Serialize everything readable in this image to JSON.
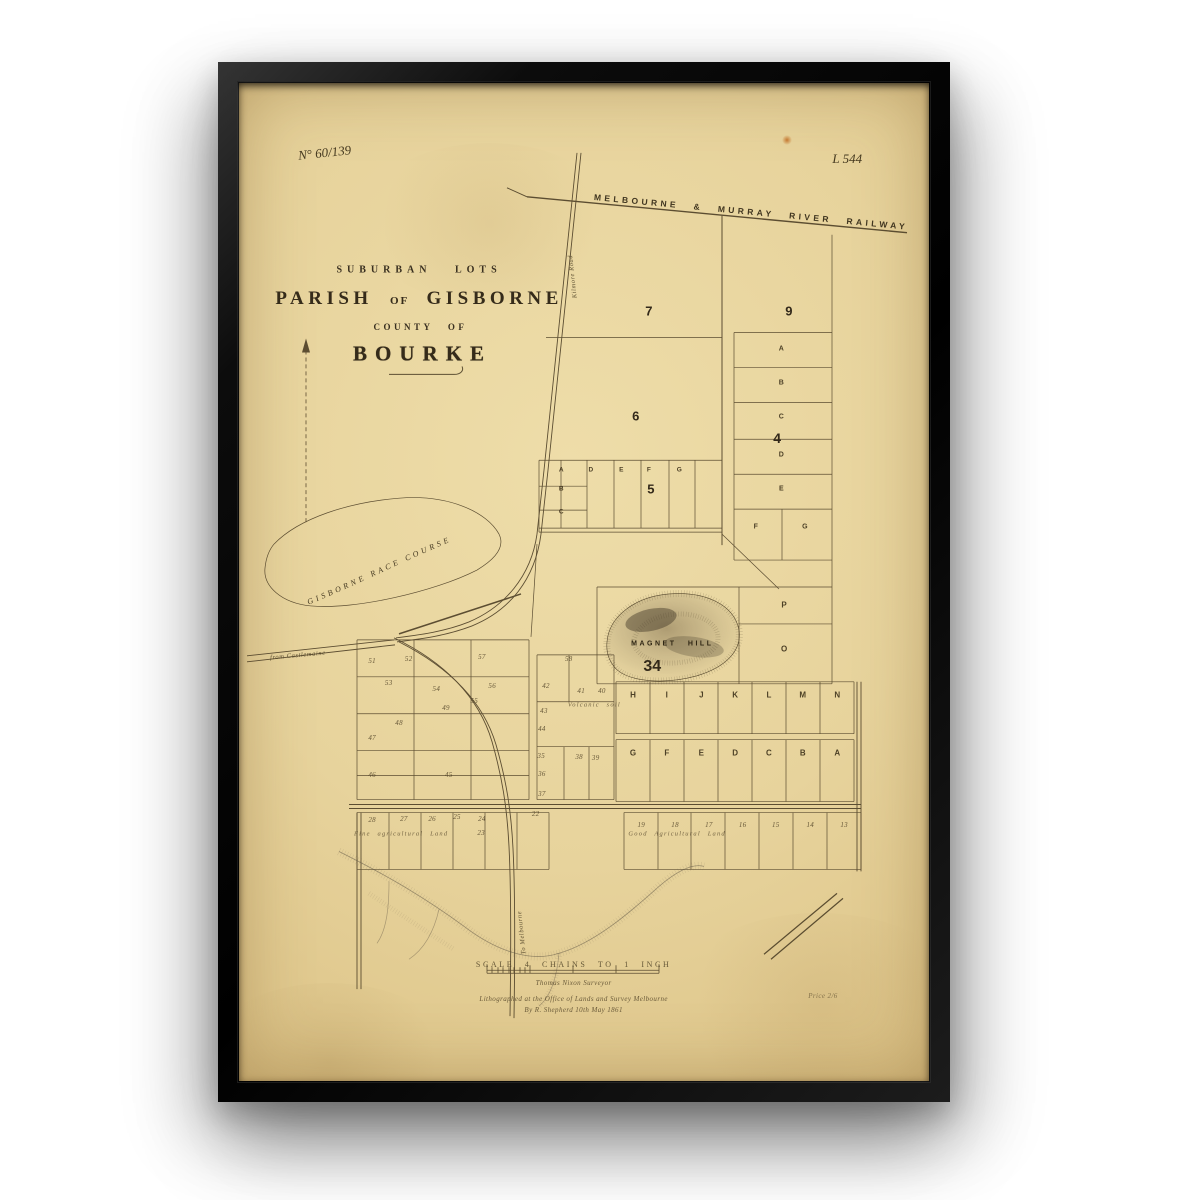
{
  "map": {
    "plate_no": "N° 60/139",
    "plate_ref": "L 544",
    "railway_label": "MELBOURNE & MURRAY RIVER RAILWAY",
    "title_line1": "SUBURBAN LOTS",
    "title_parish": "PARISH",
    "title_of": "OF",
    "title_gisborne": "GISBORNE",
    "title_line3": "COUNTY OF",
    "title_line4": "BOURKE",
    "race_course_label": "GISBORNE RACE COURSE",
    "magnet_hill_label": "MAGNET HILL",
    "magnet_hill_number": "34",
    "road_from_castlemaine": "from Castlemaine",
    "road_kilmore": "Kilmore Road",
    "road_to_melbourne": "To Melbourne",
    "sections": [
      {
        "label": "7",
        "x": 59.4,
        "y": 22.8,
        "size": 13
      },
      {
        "label": "9",
        "x": 79.7,
        "y": 22.8,
        "size": 13
      },
      {
        "label": "6",
        "x": 57.5,
        "y": 33.4,
        "size": 13
      },
      {
        "label": "5",
        "x": 59.7,
        "y": 40.7,
        "size": 13
      },
      {
        "label": "4",
        "x": 78.0,
        "y": 35.6,
        "size": 14
      }
    ],
    "letters": [
      {
        "ch": "A",
        "x": 78.6,
        "y": 26.7,
        "size": 7
      },
      {
        "ch": "B",
        "x": 78.6,
        "y": 30.1,
        "size": 7
      },
      {
        "ch": "C",
        "x": 78.6,
        "y": 33.5,
        "size": 7
      },
      {
        "ch": "D",
        "x": 78.6,
        "y": 37.3,
        "size": 7
      },
      {
        "ch": "E",
        "x": 78.6,
        "y": 40.7,
        "size": 7
      },
      {
        "ch": "F",
        "x": 74.9,
        "y": 44.5,
        "size": 7
      },
      {
        "ch": "G",
        "x": 82.0,
        "y": 44.5,
        "size": 7
      },
      {
        "ch": "A",
        "x": 46.7,
        "y": 38.8,
        "size": 6.5
      },
      {
        "ch": "D",
        "x": 51.0,
        "y": 38.8,
        "size": 6.5
      },
      {
        "ch": "E",
        "x": 55.4,
        "y": 38.8,
        "size": 6.5
      },
      {
        "ch": "F",
        "x": 59.4,
        "y": 38.8,
        "size": 6.5
      },
      {
        "ch": "G",
        "x": 63.8,
        "y": 38.8,
        "size": 6.5
      },
      {
        "ch": "B",
        "x": 46.7,
        "y": 40.7,
        "size": 6.5
      },
      {
        "ch": "C",
        "x": 46.7,
        "y": 43.0,
        "size": 6.5
      },
      {
        "ch": "P",
        "x": 79.0,
        "y": 52.3,
        "size": 8
      },
      {
        "ch": "O",
        "x": 79.0,
        "y": 56.7,
        "size": 8
      },
      {
        "ch": "H",
        "x": 57.1,
        "y": 61.3,
        "size": 8
      },
      {
        "ch": "I",
        "x": 62.0,
        "y": 61.3,
        "size": 8
      },
      {
        "ch": "J",
        "x": 67.0,
        "y": 61.3,
        "size": 8
      },
      {
        "ch": "K",
        "x": 71.9,
        "y": 61.3,
        "size": 8
      },
      {
        "ch": "L",
        "x": 76.8,
        "y": 61.3,
        "size": 8
      },
      {
        "ch": "M",
        "x": 81.7,
        "y": 61.3,
        "size": 8
      },
      {
        "ch": "N",
        "x": 86.7,
        "y": 61.3,
        "size": 8
      },
      {
        "ch": "G",
        "x": 57.1,
        "y": 67.1,
        "size": 8
      },
      {
        "ch": "F",
        "x": 62.0,
        "y": 67.1,
        "size": 8
      },
      {
        "ch": "E",
        "x": 67.0,
        "y": 67.1,
        "size": 8
      },
      {
        "ch": "D",
        "x": 71.9,
        "y": 67.1,
        "size": 8
      },
      {
        "ch": "C",
        "x": 76.8,
        "y": 67.1,
        "size": 8
      },
      {
        "ch": "B",
        "x": 81.7,
        "y": 67.1,
        "size": 8
      },
      {
        "ch": "A",
        "x": 86.7,
        "y": 67.1,
        "size": 8
      }
    ],
    "lots": [
      {
        "n": "51",
        "x": 19.3,
        "y": 57.9
      },
      {
        "n": "52",
        "x": 24.6,
        "y": 57.7
      },
      {
        "n": "57",
        "x": 35.2,
        "y": 57.5
      },
      {
        "n": "58",
        "x": 47.8,
        "y": 57.7
      },
      {
        "n": "53",
        "x": 21.7,
        "y": 60.1
      },
      {
        "n": "54",
        "x": 28.6,
        "y": 60.7
      },
      {
        "n": "56",
        "x": 36.7,
        "y": 60.4
      },
      {
        "n": "55",
        "x": 34.1,
        "y": 61.9
      },
      {
        "n": "49",
        "x": 30.0,
        "y": 62.6
      },
      {
        "n": "48",
        "x": 23.2,
        "y": 64.1
      },
      {
        "n": "47",
        "x": 19.3,
        "y": 65.6
      },
      {
        "n": "46",
        "x": 19.3,
        "y": 69.3
      },
      {
        "n": "45",
        "x": 30.4,
        "y": 69.3
      },
      {
        "n": "42",
        "x": 44.5,
        "y": 60.4
      },
      {
        "n": "41",
        "x": 49.6,
        "y": 60.9
      },
      {
        "n": "40",
        "x": 52.6,
        "y": 60.9
      },
      {
        "n": "43",
        "x": 44.2,
        "y": 62.9
      },
      {
        "n": "44",
        "x": 43.9,
        "y": 64.7
      },
      {
        "n": "35",
        "x": 43.8,
        "y": 67.4
      },
      {
        "n": "38",
        "x": 49.3,
        "y": 67.5
      },
      {
        "n": "39",
        "x": 51.7,
        "y": 67.6
      },
      {
        "n": "36",
        "x": 43.9,
        "y": 69.2
      },
      {
        "n": "37",
        "x": 43.9,
        "y": 71.2
      },
      {
        "n": "28",
        "x": 19.3,
        "y": 73.8
      },
      {
        "n": "27",
        "x": 23.9,
        "y": 73.7
      },
      {
        "n": "26",
        "x": 28.0,
        "y": 73.7
      },
      {
        "n": "25",
        "x": 31.6,
        "y": 73.5
      },
      {
        "n": "24",
        "x": 35.2,
        "y": 73.7
      },
      {
        "n": "23",
        "x": 35.1,
        "y": 75.2
      },
      {
        "n": "22",
        "x": 43.0,
        "y": 73.2
      },
      {
        "n": "19",
        "x": 58.3,
        "y": 74.3
      },
      {
        "n": "18",
        "x": 63.2,
        "y": 74.3
      },
      {
        "n": "17",
        "x": 68.1,
        "y": 74.3
      },
      {
        "n": "16",
        "x": 73.0,
        "y": 74.3
      },
      {
        "n": "15",
        "x": 77.8,
        "y": 74.3
      },
      {
        "n": "14",
        "x": 82.8,
        "y": 74.3
      },
      {
        "n": "13",
        "x": 87.7,
        "y": 74.3
      }
    ],
    "notes": [
      {
        "text": "Volcanic soil",
        "x": 51.5,
        "y": 62.3
      },
      {
        "text": "Fine agricultural Land",
        "x": 23.5,
        "y": 75.3
      },
      {
        "text": "Good Agricultural Land",
        "x": 63.5,
        "y": 75.3
      }
    ],
    "scale": {
      "title": "SCALE 4 CHAINS TO 1 INCH",
      "surveyor": "Thomas Nixon Surveyor",
      "litho_line1": "Lithographed at the Office of Lands and Survey Melbourne",
      "litho_line2": "By R. Shepherd 10th May 1861",
      "price_mark": "Price 2/6"
    }
  }
}
